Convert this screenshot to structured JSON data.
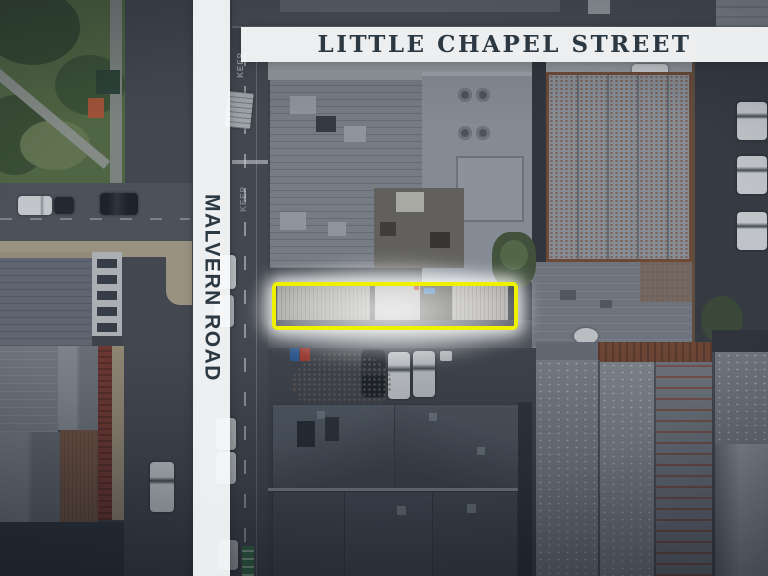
{
  "map": {
    "street_labels": {
      "top_band": "LITTLE CHAPEL STREET",
      "left_band": "MALVERN ROAD"
    },
    "road_marking": "KEEP"
  },
  "colors": {
    "highlight_yellow": "#eef200",
    "glow_white": "#ffffff",
    "label_text": "#2c3842",
    "band_bg": "rgba(251,252,253,0.93)"
  }
}
